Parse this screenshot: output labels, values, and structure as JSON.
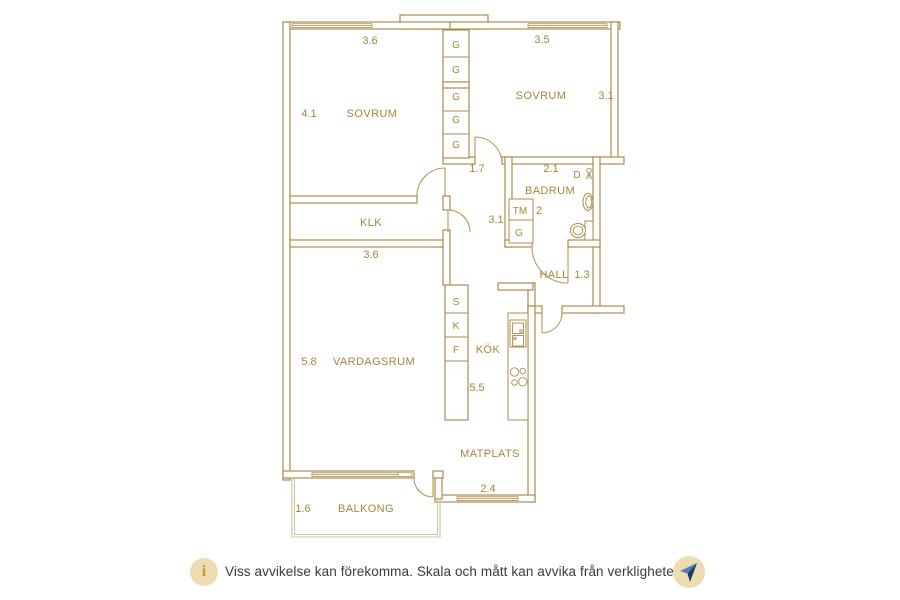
{
  "plan": {
    "sovrum1": {
      "name": "SOVRUM",
      "dim_top": "3.6",
      "dim_left": "4.1"
    },
    "sovrum2": {
      "name": "SOVRUM",
      "dim_top": "3.5",
      "dim_right": "3.1"
    },
    "closets": {
      "g1": "G",
      "g2": "G",
      "g3": "G",
      "g4": "G",
      "g5": "G"
    },
    "corridor": {
      "dim": "1.7",
      "dim2": "3.1"
    },
    "badrum": {
      "name": "BADRUM",
      "dim_top": "2.1",
      "dim_width": "2",
      "shower": "D",
      "washer": "TM",
      "closet": "G"
    },
    "hall": {
      "name": "HALL",
      "dim": "1.3"
    },
    "klk": {
      "name": "KLK",
      "dim_bottom": "3.6"
    },
    "vardagsrum": {
      "name": "VARDAGSRUM",
      "dim_left": "5.8"
    },
    "kok": {
      "name": "KÖK",
      "dim": "5.5",
      "cab1": "S",
      "cab2": "K",
      "cab3": "F"
    },
    "matplats": {
      "name": "MATPLATS",
      "dim": "2.4"
    },
    "balkong": {
      "name": "BALKONG",
      "dim_left": "1.6"
    }
  },
  "footer": {
    "info_icon": "i",
    "disclaimer": "Viss avvikelse kan förekomma. Skala och mått kan avvika från verkligheten.",
    "compass_icon": "north-arrow"
  },
  "colors": {
    "plan_line": "#a98e4c",
    "plan_text": "#a1873e",
    "footer_text": "#3a3a3c",
    "badge_bg": "#eddcb2",
    "info_glyph": "#c09a3e",
    "compass_dark": "#1c3a67",
    "compass_light": "#4d7cb8"
  }
}
